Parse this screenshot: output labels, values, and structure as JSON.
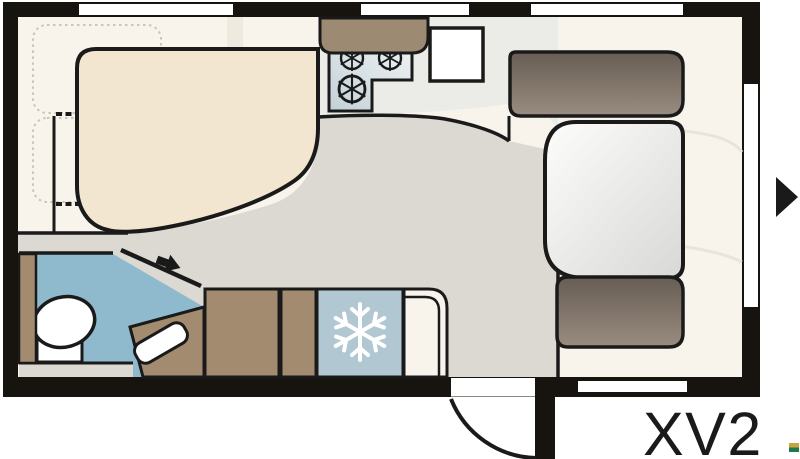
{
  "labels": {
    "model": "XV2"
  },
  "icons": {
    "snowflake": "snowflake-icon (fridge/freezer)",
    "burners": "gas-burner-icon x3 (stove)",
    "entry_arrow": "entrance-arrow-icon (right side door)",
    "bath_arrow": "door-direction-arrow-icon (bathroom)",
    "logo": "brand-logo-mark (gold/green)"
  },
  "palette": {
    "ink": "#1a1a1a",
    "wall": "#17130e",
    "background": "#ffffff",
    "interior": "#f8f4ec",
    "kitchenArea": "#ebebe7",
    "floor": "#dcd8d2",
    "bed": "#f2e6d0",
    "dotted": "#c9c5bc",
    "lockerBand": "#efeade",
    "bathBlue": "#8fbacd",
    "cabinetBrown": "#a28b6f",
    "beige": "#d7cfbf",
    "beigeStroke": "#b2ab9c",
    "fridgeBlue": "#b1c7d2",
    "stoveLight": "#eef2f4",
    "stoveDark": "#c2d1d7",
    "counterBrown": "#9c8a72",
    "benchDark": "#675d54",
    "benchLight": "#9a8c80",
    "tableLight": "#fdfdfc",
    "tableDark": "#d8d8d6",
    "faintLine": "#e9e4da",
    "white": "#ffffff",
    "text": "#1a1a1a",
    "logoGold": "#c8a43e",
    "logoGreen": "#1f7a4b"
  }
}
